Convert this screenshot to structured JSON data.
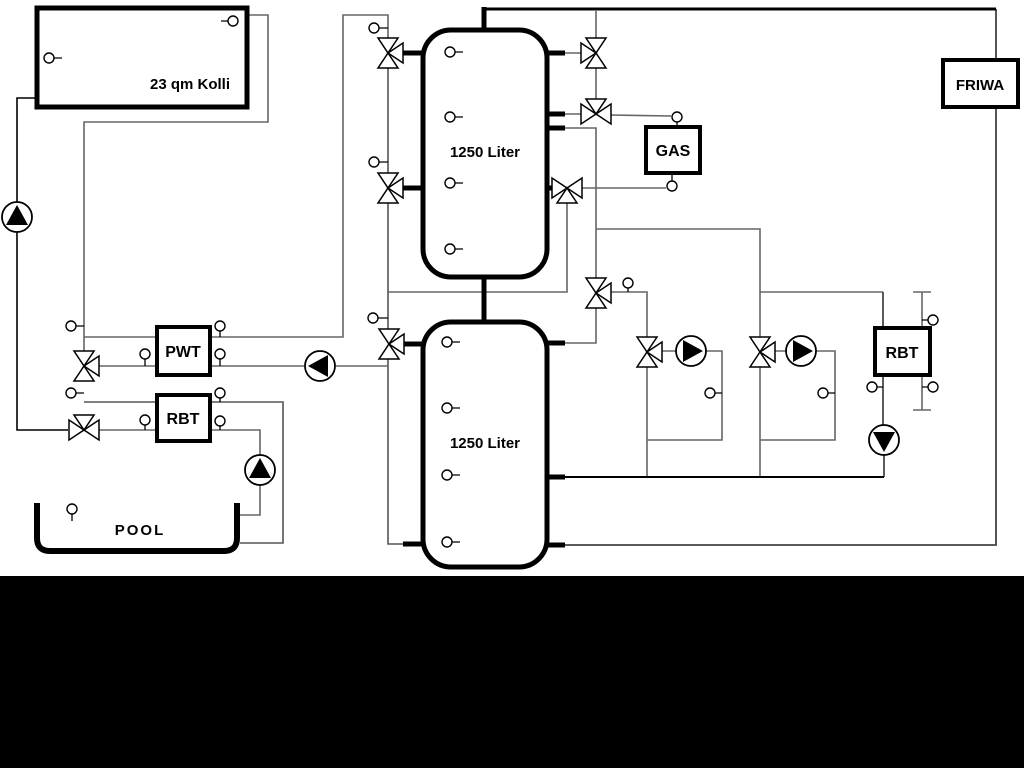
{
  "diagram": {
    "collector": {
      "label": "23 qm Kolli"
    },
    "buffer_tank_top": {
      "label": "1250 Liter"
    },
    "buffer_tank_bottom": {
      "label": "1250 Liter"
    },
    "pwt": {
      "label": "PWT"
    },
    "rbt_pool": {
      "label": "RBT"
    },
    "gas_boiler": {
      "label": "GAS"
    },
    "rbt_right": {
      "label": "RBT"
    },
    "friwa": {
      "label": "FRIWA"
    },
    "pool": {
      "label": "POOL"
    },
    "colors": {
      "pipe_gray": "#666666",
      "pipe_dark": "#444444",
      "pipe_black": "#000000",
      "background": "#ffffff",
      "footer_band": "#000000"
    }
  }
}
